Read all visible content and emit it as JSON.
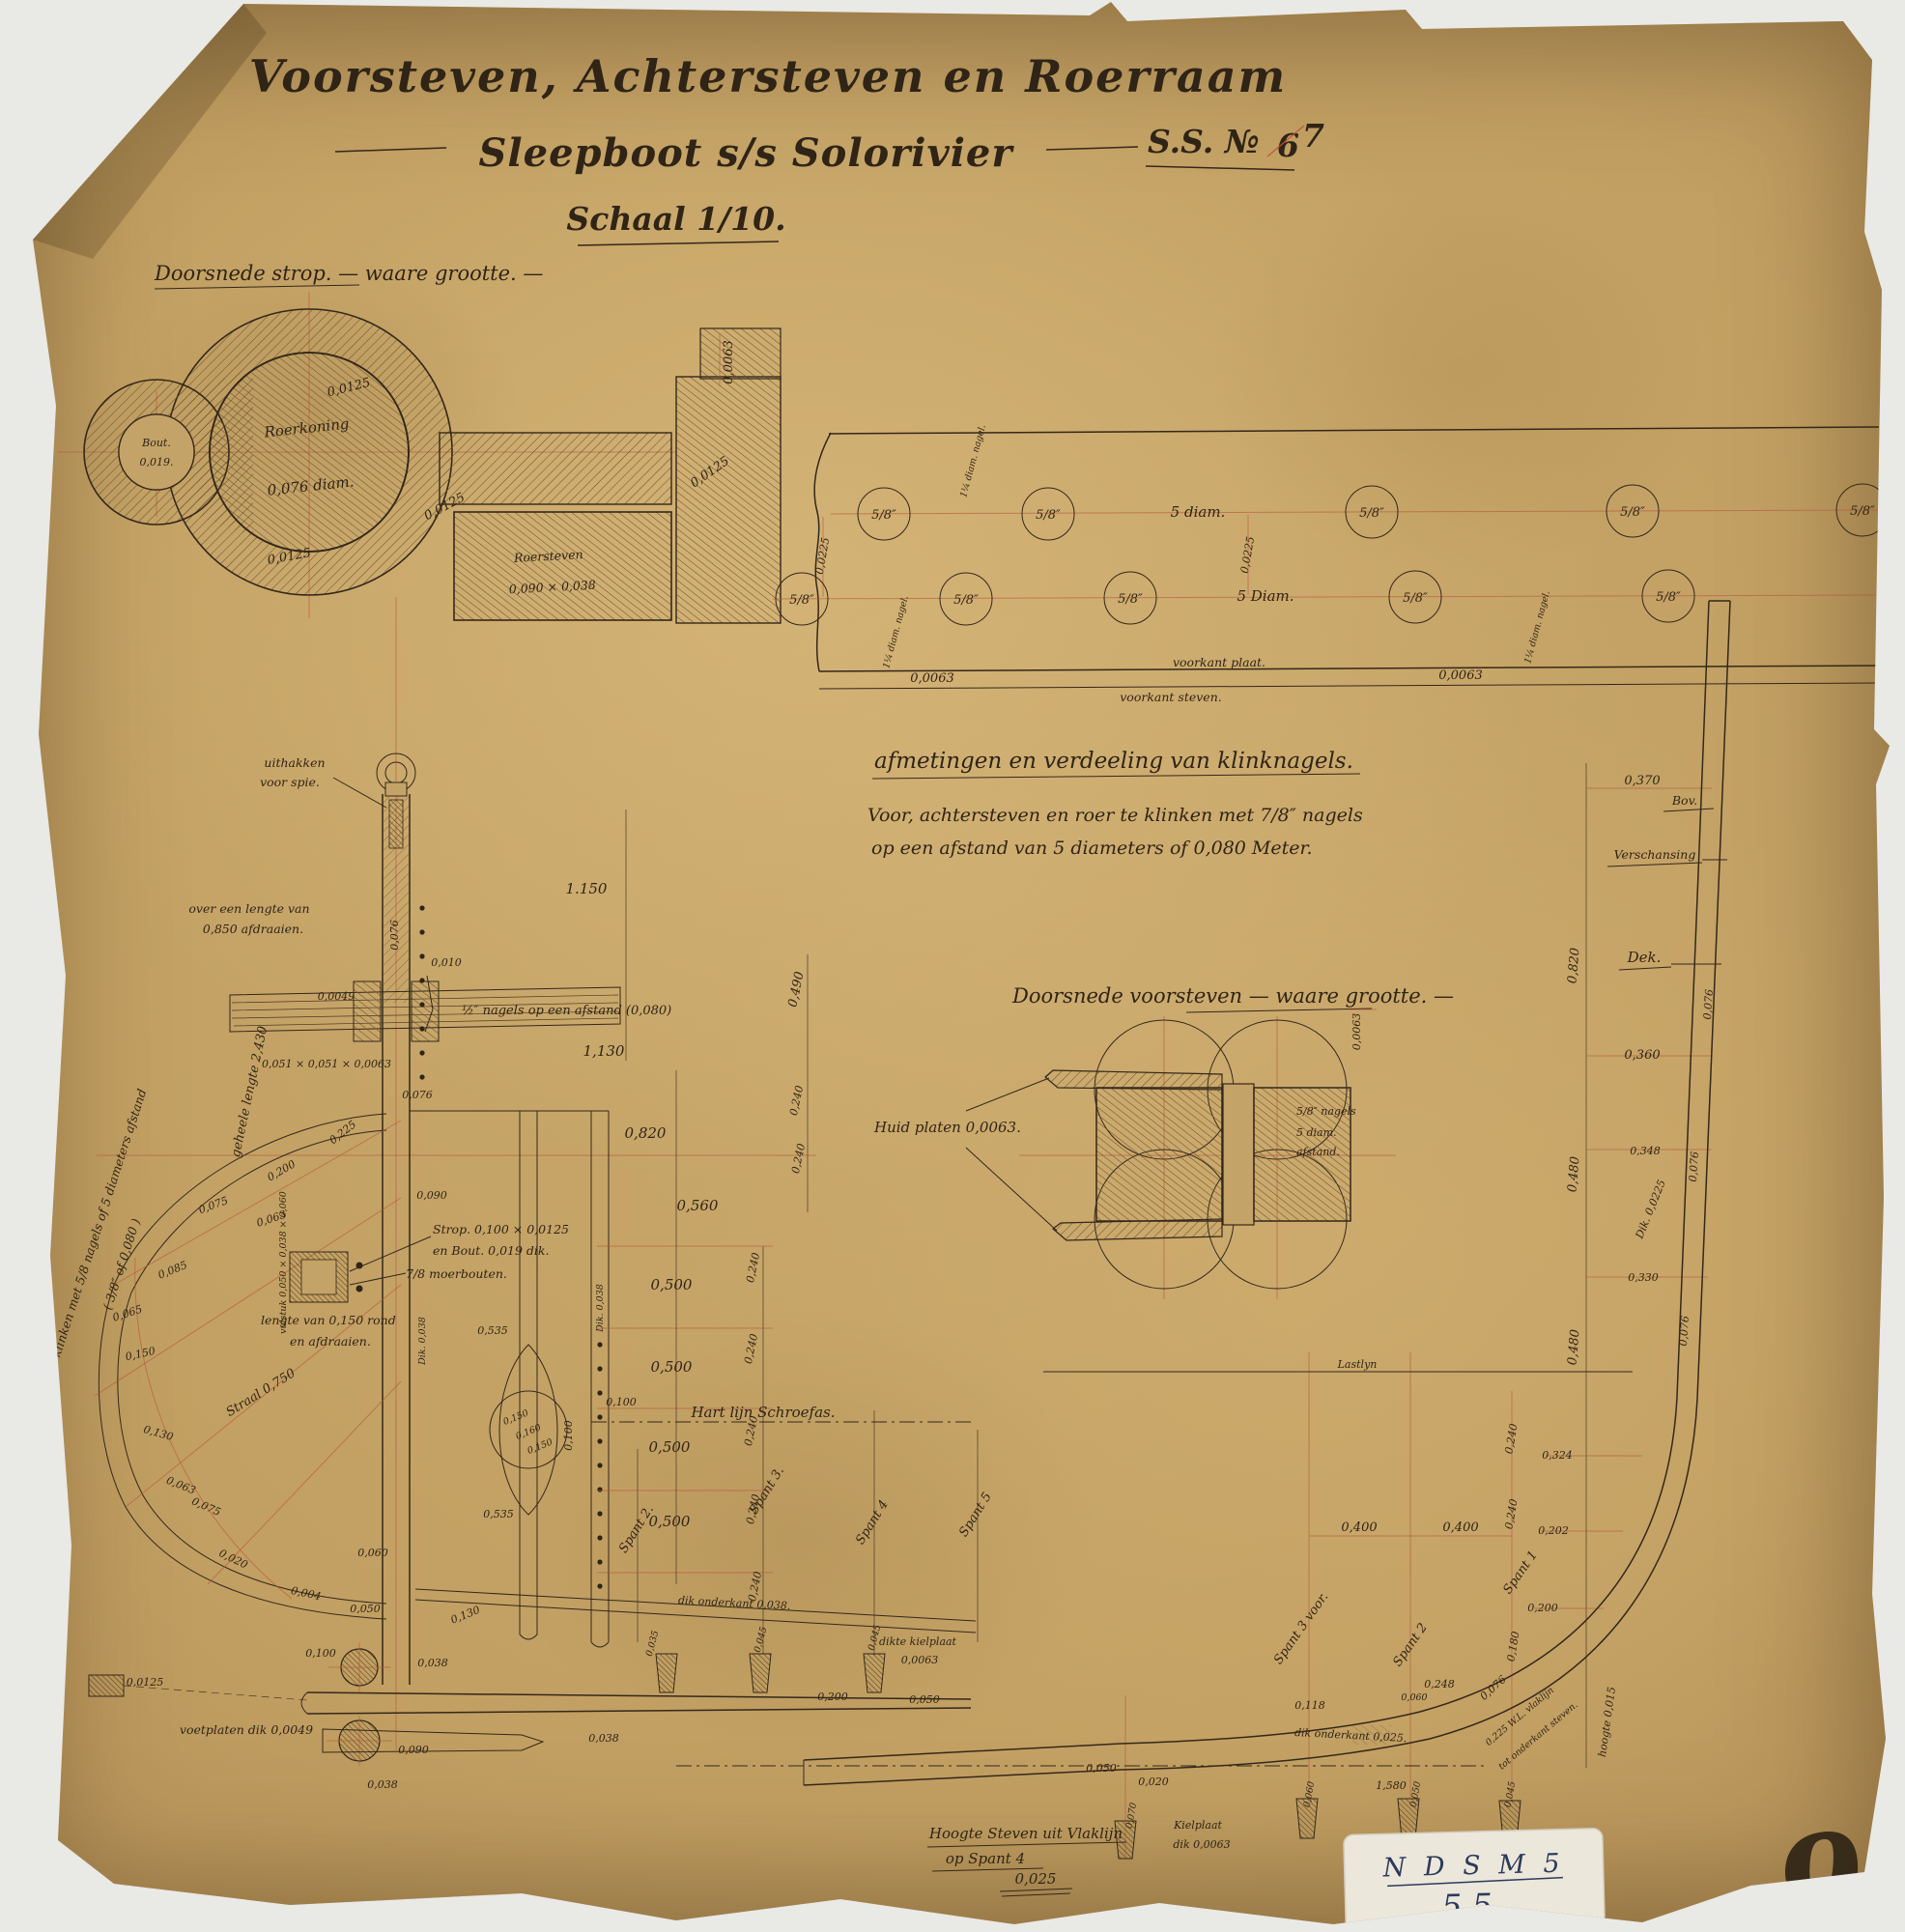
{
  "title": {
    "main": "Voorsteven, Achtersteven en Roerraam",
    "sub": "Sleepboot s/s Solorivier",
    "series": "S.S. №",
    "no_old": "6",
    "no_new": "7",
    "scale": "Schaal 1/10."
  },
  "strop": {
    "heading": "Doorsnede strop. — waare grootte. —",
    "roerkoning1": "Roerkoning",
    "roerkoning2": "0,076 diam.",
    "bout1": "Bout.",
    "bout2": "0,019.",
    "roersteven1": "Roersteven",
    "roersteven2": "0,090 × 0,038",
    "d0125": "0,0125",
    "d0063": "0,0063"
  },
  "plate": {
    "rivet": "5/8″",
    "diam5a": "5 diam.",
    "diam5b": "5 Diam.",
    "d0225": "0,0225",
    "nagel": "1¼ diam. nagel.",
    "d0063": "0,0063",
    "voorkant_plaat": "voorkant plaat.",
    "voorkant_steven": "voorkant steven."
  },
  "note": {
    "heading": "afmetingen en verdeeling van klinknagels.",
    "line1": "Voor, achtersteven en roer te klinken met 7/8″ nagels",
    "line2": "op een afstand van 5 diameters of 0,080 Meter."
  },
  "vsned": {
    "heading": "Doorsnede voorsteven — waare grootte. —",
    "huid": "Huid platen 0,0063.",
    "n1": "5/8″ nagels",
    "n2": "5 diam.",
    "n3": "afstand.",
    "d0063": "0,0063"
  },
  "ach": {
    "uithakken1": "uithakken",
    "uithakken2": "voor spie.",
    "afdraaien1": "over een lengte van",
    "afdraaien2": "0,850 afdraaien.",
    "d1150": "1.150",
    "d1130": "1,130",
    "d0820": "0,820",
    "d0560": "0,560",
    "d0500": "0,500",
    "d0490": "0,490",
    "d0240": "0,240",
    "d0010": "0,010",
    "nagels_note": "½″ nagels op een afstand (0,080)",
    "d0076": "0,076",
    "d0049": "0,0049",
    "hoekstaal": "0,051 × 0,051 × 0,0063",
    "d0225": "0,225",
    "d0200": "0,200",
    "d0090": "0,090",
    "d0063": "0,063",
    "d0075": "0,075",
    "d0085": "0,085",
    "d0065": "0,065",
    "d0150": "0,150",
    "d0130": "0,130",
    "d0020": "0,020",
    "d0004": "0,004",
    "d0050": "0,050",
    "d0060": "0,060",
    "d0100": "0,100",
    "d0535": "0,535",
    "d0160": "0,160",
    "d0038": "0,038",
    "d0035": "0,035",
    "d0045": "0,045",
    "d00125": "0,0125",
    "straal": "Straal 0,750",
    "geheele": "geheele lengte 2,430",
    "enkelt1": "enkelt klinken met 5/8 nagels of 5 diameters afstand",
    "enkelt2": "( 3/8″ of 0,080 )",
    "strop_note": "Strop. 0,100 × 0,0125",
    "bout_note": "en Bout. 0,019 dik.",
    "moerbouten": "7/8 moerbouten.",
    "vulstuk": "vulstuk 0,050 × 0,038 × 0,060",
    "lengte1": "lengte van 0,150 rond",
    "lengte2": "en afdraaien.",
    "hartlijn": "Hart lijn Schroefas.",
    "spant2": "Spant 2.",
    "spant3": "Spant 3.",
    "spant4": "Spant 4",
    "spant5": "Spant 5",
    "dik038": "Dik. 0,038",
    "dik_onderkant": "dik onderkant 0,038.",
    "kielplaat1": "dikte kielplaat",
    "kielplaat2": "0,0063",
    "voetplaten": "voetplaten dik 0,0049"
  },
  "stem": {
    "d0370": "0,370",
    "bov": "Bov.",
    "verschansing": "Verschansing",
    "dek": "Dek.",
    "d0820": "0,820",
    "d0360": "0,360",
    "d0348": "0,348",
    "d0330": "0,330",
    "d0324": "0,324",
    "d0202": "0,202",
    "d0200": "0,200",
    "d0180": "0,180",
    "d0480": "0,480",
    "d0240": "0,240",
    "d0076": "0,076",
    "dik0225": "Dik. 0,0225",
    "lastlijn": "Lastlyn",
    "d0400": "0,400",
    "d0248": "0,248",
    "d0060": "0,060",
    "d0118": "0,118",
    "spant1": "Spant 1",
    "spant2": "Spant 2",
    "spant3": "Spant 3 voor.",
    "dik_onderkant": "dik onderkant 0,025.",
    "wl1": "0,225 W.L. vlaklijn",
    "wl2": "tot onderkant steven.",
    "hoogte015": "hoogte 0,015",
    "d1580": "1,580",
    "d0050": "0,050",
    "d0020": "0,020",
    "d0070": "0,070",
    "d0045": "0,045",
    "kiel1": "Kielplaat",
    "kiel2": "dik 0,0063",
    "hoogte1": "Hoogte Steven uit Vlaklijn",
    "hoogte2": "op Spant 4",
    "hoogte3": "0,025"
  },
  "footer": {
    "sticker1": "N D S M 5",
    "sticker2": "5.5",
    "sheet": "9"
  }
}
